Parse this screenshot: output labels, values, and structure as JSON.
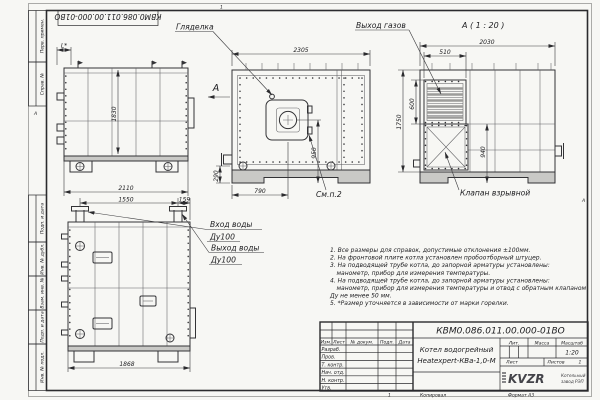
{
  "frame": {
    "zone_top": "1",
    "zone_left": "А",
    "zone_right": "А",
    "doc_number_top": "КВМ0.086.011.00.000-01ВО",
    "columns": [
      "Перв. примен.",
      "Справ. №",
      "Подп. и дата",
      "Инв. № дубл.",
      "Взам. инв. №",
      "Подп. и дата",
      "Инв. № подл."
    ],
    "kopiroval": "Копировал",
    "format": "Формат А3",
    "sheet_no": "1"
  },
  "labels": {
    "sight_glass": "Гляделка",
    "gas_outlet": "Выход газов",
    "view_a": "А ( 1 : 20 )",
    "view_arrow": "А",
    "see_note": "См.п.2",
    "explosion_valve": "Клапан взрывной",
    "water_inlet_1": "Вход воды",
    "water_inlet_2": "Ду100",
    "water_outlet_1": "Выход воды",
    "water_outlet_2": "Ду100"
  },
  "dims": {
    "side": {
      "width": "2110",
      "height": "1830",
      "burner": "L*"
    },
    "front": {
      "width": "2305",
      "burner_x": "790",
      "burner_y": "950",
      "base": "290"
    },
    "rear": {
      "width": "2030",
      "outlet_w": "510",
      "outlet_h": "600",
      "height": "1750",
      "valve": "940"
    },
    "back": {
      "pipes": "1550",
      "edge": "159",
      "width": "1868"
    }
  },
  "notes": [
    "1. Все размеры для справок, допустимые отклонения ±100мм.",
    "2. На фронтовой плите котла установлен пробоотборный штуцер.",
    "3. На подводящей трубе котла, до запорной арматуры установлены:",
    "манометр, прибор для измерения температуры.",
    "4. На подводящей трубе котла, до запорной арматуры установлены:",
    "манометр, прибор для измерения температуры и отвод с обратным клапаном",
    "Ду не менее 50 мм.",
    "5. *Размер уточняется в зависимости от марки горелки."
  ],
  "title_block": {
    "doc_number": "КВМ0.086.011.00.000-01ВО",
    "product": "Котел водогрейный",
    "product2": "Heatexpert-КВа-1,0-М",
    "h_izm": "Изм.",
    "h_list": "Лист",
    "h_doc": "№ докум.",
    "h_podp": "Подп.",
    "h_data": "Дата",
    "r1": "Разраб.",
    "r2": "Пров.",
    "r3": "Т. контр.",
    "r4": "Нач. отд.",
    "r5": "Н. контр.",
    "r6": "Утв.",
    "lit": "Лит.",
    "massa": "Масса",
    "scale_label": "Масштаб",
    "scale": "1:20",
    "list": "Лист",
    "listov": "Листов",
    "listov_val": "1",
    "logo": "KVZR",
    "company1": "Котельный",
    "company2": "завод РЭП"
  }
}
